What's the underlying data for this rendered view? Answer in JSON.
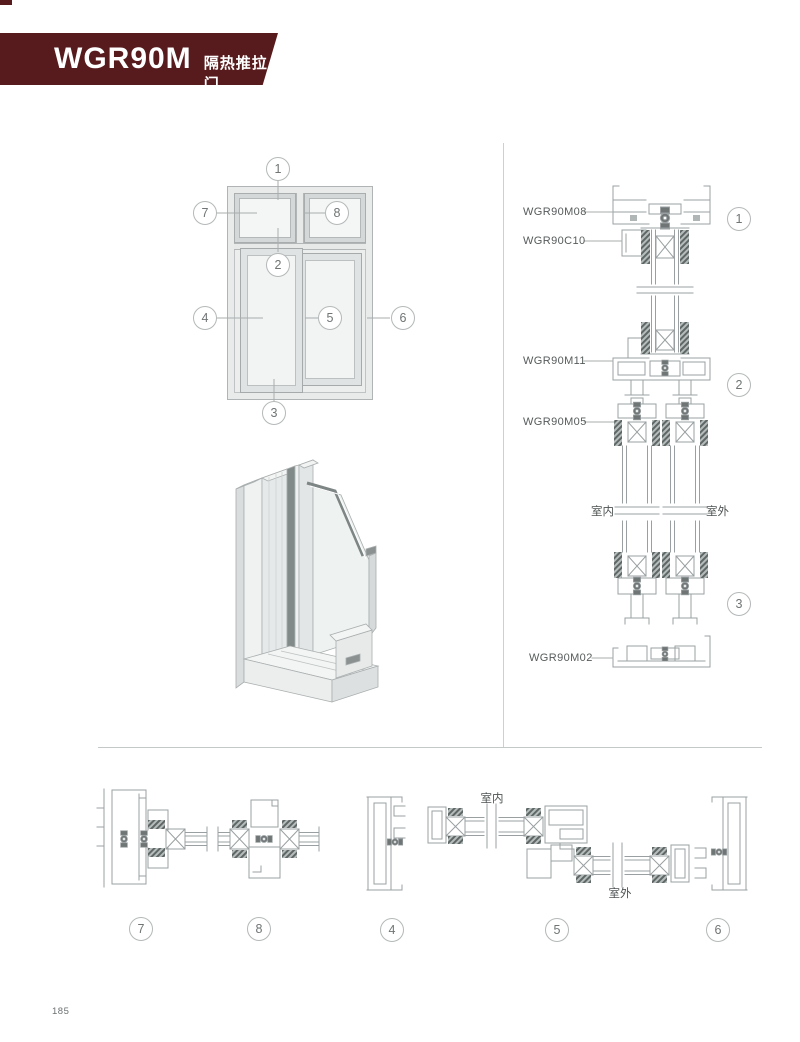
{
  "header": {
    "title": "WGR90M",
    "subtitle": "隔热推拉门",
    "banner_color": "#581b1d"
  },
  "elevation_callouts": [
    "1",
    "7",
    "8",
    "2",
    "4",
    "5",
    "6",
    "3"
  ],
  "vertical_section": {
    "profile_labels": [
      "WGR90M08",
      "WGR90C10",
      "WGR90M11",
      "WGR90M05",
      "WGR90M02"
    ],
    "callouts": [
      "1",
      "2",
      "3"
    ],
    "indoor_label": "室内",
    "outdoor_label": "室外"
  },
  "horizontal_section": {
    "callouts": [
      "7",
      "8",
      "4",
      "5",
      "6"
    ],
    "indoor_label": "室内",
    "outdoor_label": "室外"
  },
  "footer": {
    "page_number": "185"
  },
  "colors": {
    "accent": "#581b1d",
    "line": "#9aa0a2"
  }
}
